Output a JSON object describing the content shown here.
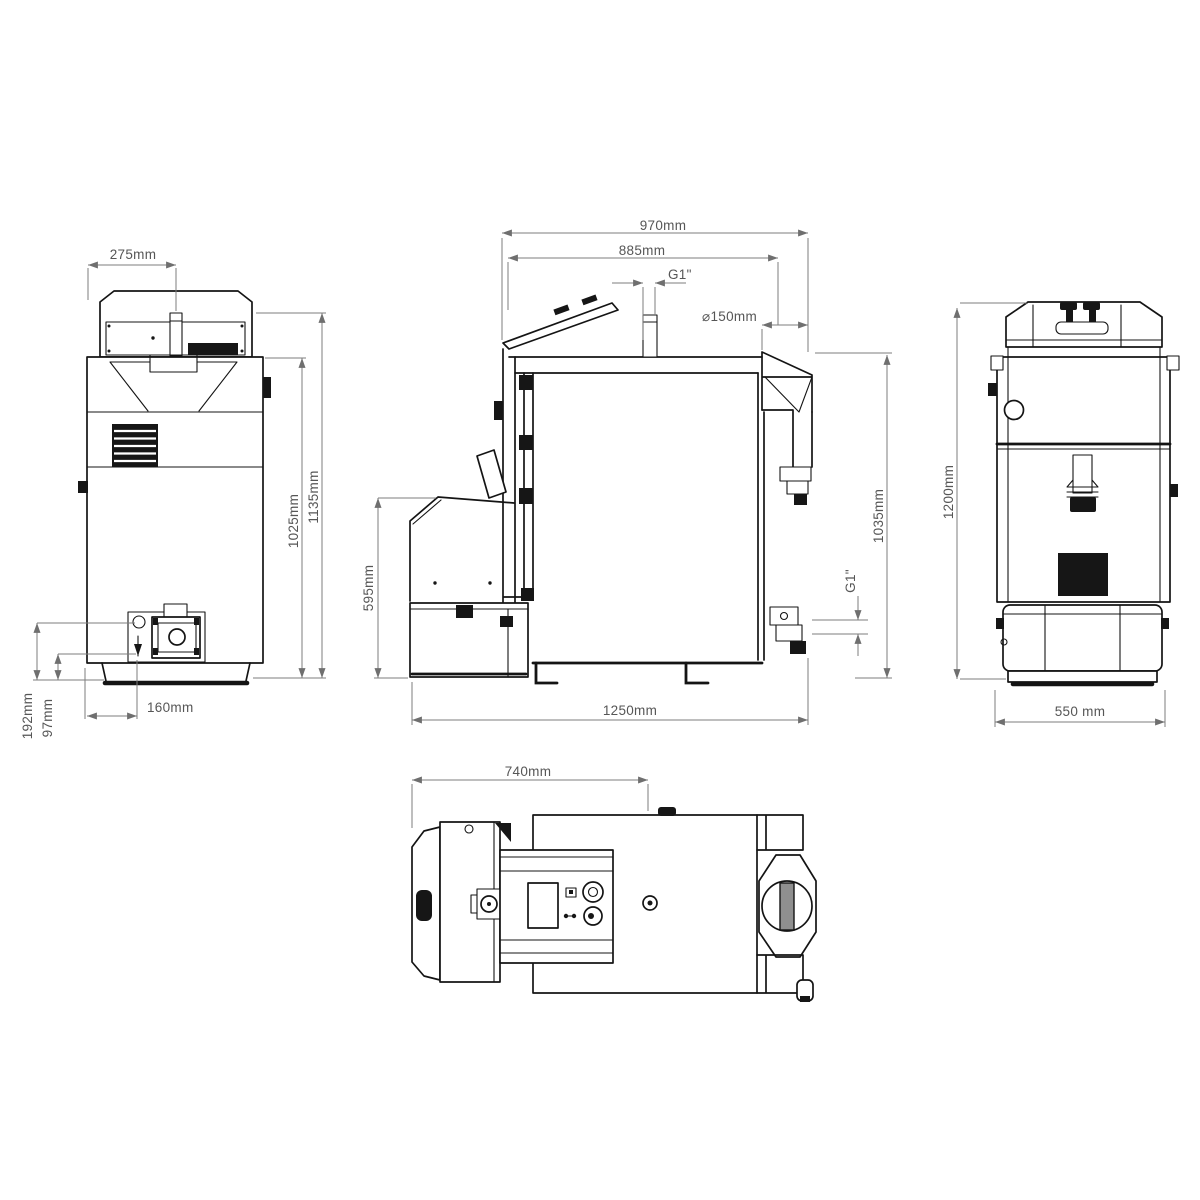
{
  "canvas": {
    "background": "#ffffff",
    "line_color": "#141414",
    "dimension_line_color": "#7d7d7d",
    "dimension_text_color": "#565656"
  },
  "views": {
    "front": {
      "name": "front-view",
      "dims": {
        "hopper_pipe_offset": "275mm",
        "body_height": "1025mm",
        "overall_height": "1135mm",
        "burner_axis_height": "192mm",
        "lower_axis_height": "97mm",
        "burner_offset": "160mm"
      }
    },
    "side": {
      "name": "side-view",
      "dims": {
        "top_depth": "970mm",
        "mid_depth": "885mm",
        "flow_connection": "G1\"",
        "flue_diameter": "⌀150mm",
        "burner_unit_height": "595mm",
        "flue_outlet_height": "1035mm",
        "return_connection": "G1\"",
        "overall_depth": "1250mm"
      }
    },
    "back": {
      "name": "back-view",
      "dims": {
        "overall_height": "1200mm",
        "overall_width": "550 mm"
      }
    },
    "top": {
      "name": "top-view",
      "dims": {
        "burner_body_depth": "740mm"
      }
    }
  }
}
